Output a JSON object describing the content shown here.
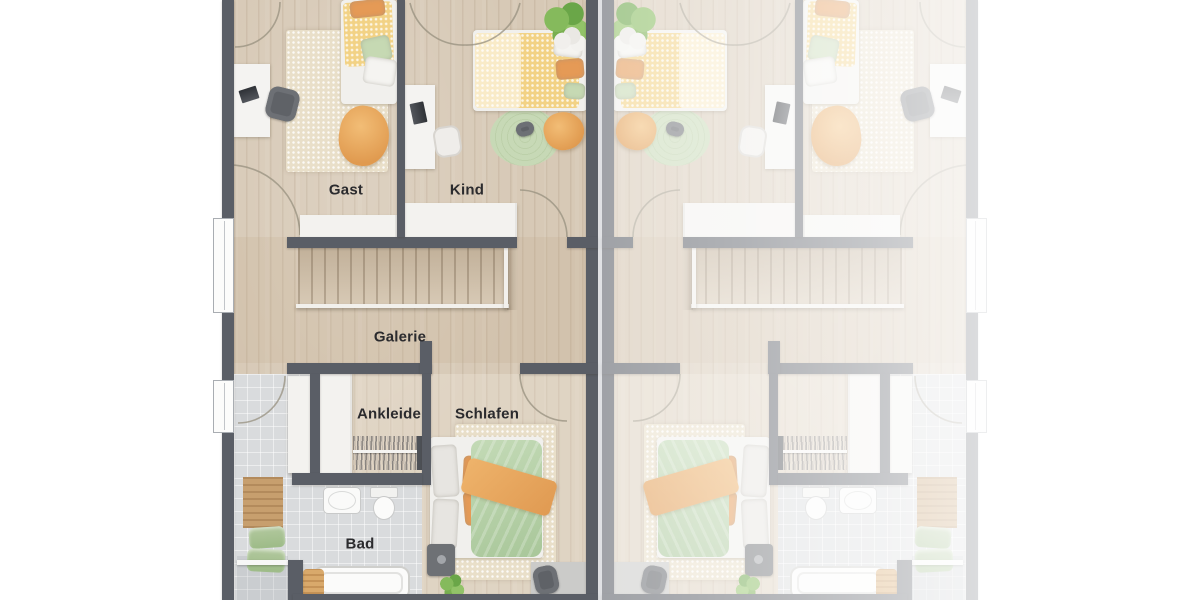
{
  "rooms": {
    "gast": "Gast",
    "kind": "Kind",
    "galerie": "Galerie",
    "ankleide": "Ankleide",
    "schlafen": "Schlafen",
    "bad": "Bad"
  },
  "palette": {
    "wall": "#5a5e66",
    "floor": "#d7c9b6",
    "tile": "#d9dbdd",
    "white": "#f3f2ef",
    "text": "#2b2b2e",
    "bed-green": "#b7d1a9",
    "bed-orange": "#e9ab62",
    "bed-yellow": "#f2d285",
    "rug-cream": "#e9dfc9",
    "rug-green": "#c7d9b6",
    "plant": "#7cb458",
    "accent-orange": "#e59a56",
    "rail-white": "#f2f0ec"
  }
}
